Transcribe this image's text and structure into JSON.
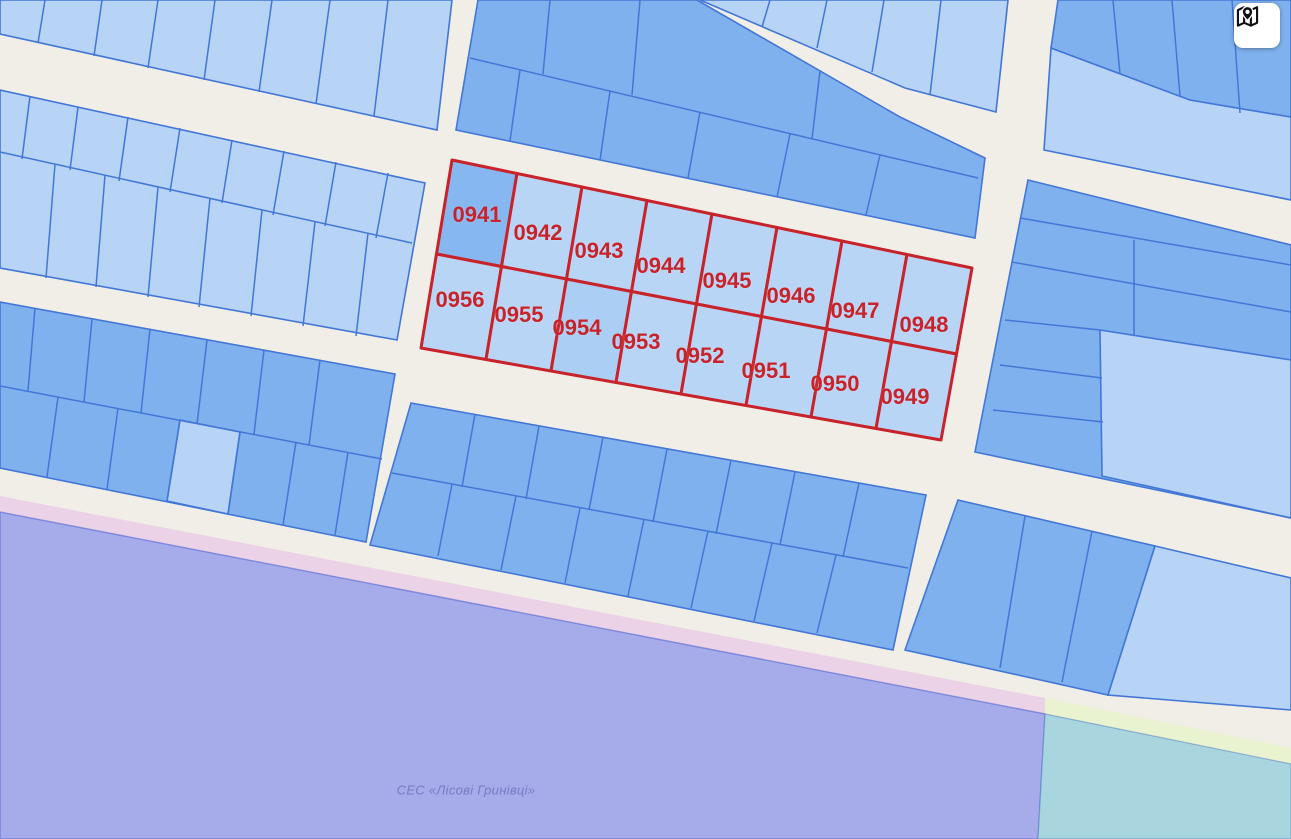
{
  "map": {
    "selected_parcels": {
      "labels": [
        "0941",
        "0942",
        "0943",
        "0944",
        "0945",
        "0946",
        "0947",
        "0948",
        "0956",
        "0955",
        "0954",
        "0953",
        "0952",
        "0951",
        "0950",
        "0949"
      ]
    },
    "area_label": "СЕС «Лісові Гринівці»",
    "button": {
      "icon": "map-location-icon"
    },
    "colors": {
      "street": "#f0eee6",
      "parcel_light": "#b7d3f5",
      "parcel_medium": "#7fb1ee",
      "parcel_border": "#4377d6",
      "highlight": "#c8232a",
      "highlight_fill": "#b9d5f6",
      "highlight_fill_dark": "#87b7f0",
      "highlight_fill_mid": "#abcef4",
      "zone_purple": "#a6abe9",
      "zone_pink": "#ecd2e6",
      "zone_teal": "#a9d5de",
      "zone_yellow": "#eaf3cf",
      "label_text": "#c8232a",
      "area_text": "#767bc5"
    }
  }
}
